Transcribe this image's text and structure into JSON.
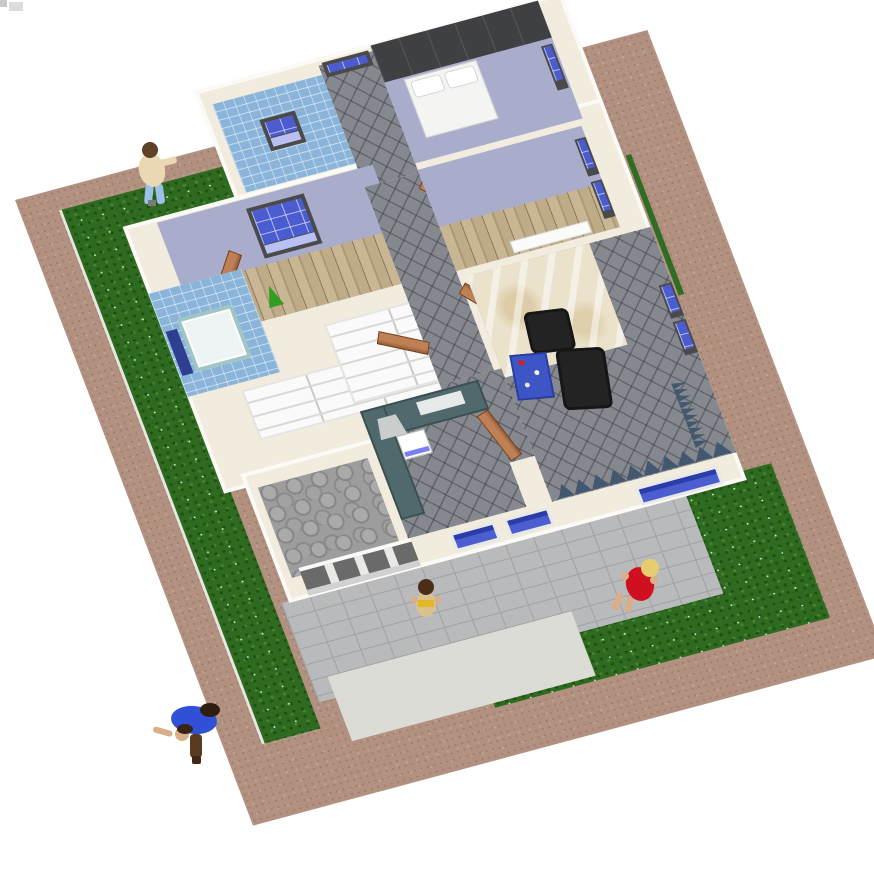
{
  "scene": {
    "description": "Aerial 3D rendering of a single-storey house model on a landscaped lot",
    "viewport": {
      "width_px": 874,
      "height_px": 884,
      "background": "#ffffff"
    },
    "ground": {
      "soil_color": "#b29181",
      "grass_color": "#2e6a1f",
      "flower_color": "#e9efe4",
      "paver_color": "#b8babc",
      "gravel_color": "#dcdcd6",
      "cobblestone_color": "#9d9d9d",
      "areas": [
        {
          "name": "soil border"
        },
        {
          "name": "west grass strip"
        },
        {
          "name": "northwest grass strip"
        },
        {
          "name": "southeast lawn"
        },
        {
          "name": "entry path"
        },
        {
          "name": "driveway patio"
        },
        {
          "name": "gravel strip"
        },
        {
          "name": "hedge line"
        }
      ]
    },
    "house": {
      "wall_top_color": "#f1ecdd",
      "wall_face_color": "#fbfaf6",
      "window_frame_color": "#4a4a4a",
      "window_glass_color": "#4a5cd0",
      "window_glass_light": "#b8c0f4",
      "door_color": "#b5774e",
      "rooms": [
        {
          "name": "North bathroom",
          "finish": "blue wall tiles",
          "tile_color": "#8ab4da"
        },
        {
          "name": "North bedroom",
          "wall_color": "#a9adcb",
          "furniture": "dark wardrobe and double bed"
        },
        {
          "name": "Entry hall",
          "floor": "grey diagonal tiles",
          "floor_color": "#85888f"
        },
        {
          "name": "West bedroom",
          "wall_color": "#a9adcb",
          "floor": "wood planks",
          "floor_color": "#bfab88"
        },
        {
          "name": "West shower room",
          "finish": "blue wall tiles",
          "shower_tray_color": "#eef4f4",
          "cabinet_color": "#2e3f8f"
        },
        {
          "name": "Storage shelving",
          "shelf_color": "#fafafa"
        },
        {
          "name": "Hallway",
          "floor": "grey diagonal tiles"
        },
        {
          "name": "East bedroom",
          "wall_color": "#a9adcb",
          "floor": "wood planks"
        },
        {
          "name": "Living room",
          "floor": "grey carpet with beige marble entry",
          "marble_color": "#ebe2cb",
          "sofa_color": "#232323",
          "coffee_table_color": "#3d55c5",
          "curtain_color": "#42586e"
        },
        {
          "name": "Kitchen",
          "cabinet_color": "#50696c",
          "hood_color": "#c9cdcc",
          "stove_color": "#ffffff",
          "floor": "grey diagonal tiles"
        },
        {
          "name": "Garage",
          "floor": "grey flagstones",
          "door_opening_color": "#6a6a6a"
        }
      ]
    },
    "people": [
      {
        "name": "visitor on northwest grass",
        "hair": "#5f4128",
        "top": "#ead9b4",
        "trousers": "#9cc0e8"
      },
      {
        "name": "man bending on driveway",
        "hair": "#2e1d10",
        "top": "#3050d8",
        "trousers": "#5a3a22"
      },
      {
        "name": "woman in living room",
        "hair": "#e8cd6e",
        "dress": "#d01020"
      },
      {
        "name": "child at kitchen door",
        "hair": "#4a2e16",
        "top": "#d9c28c",
        "accent": "#e0b828"
      }
    ]
  }
}
